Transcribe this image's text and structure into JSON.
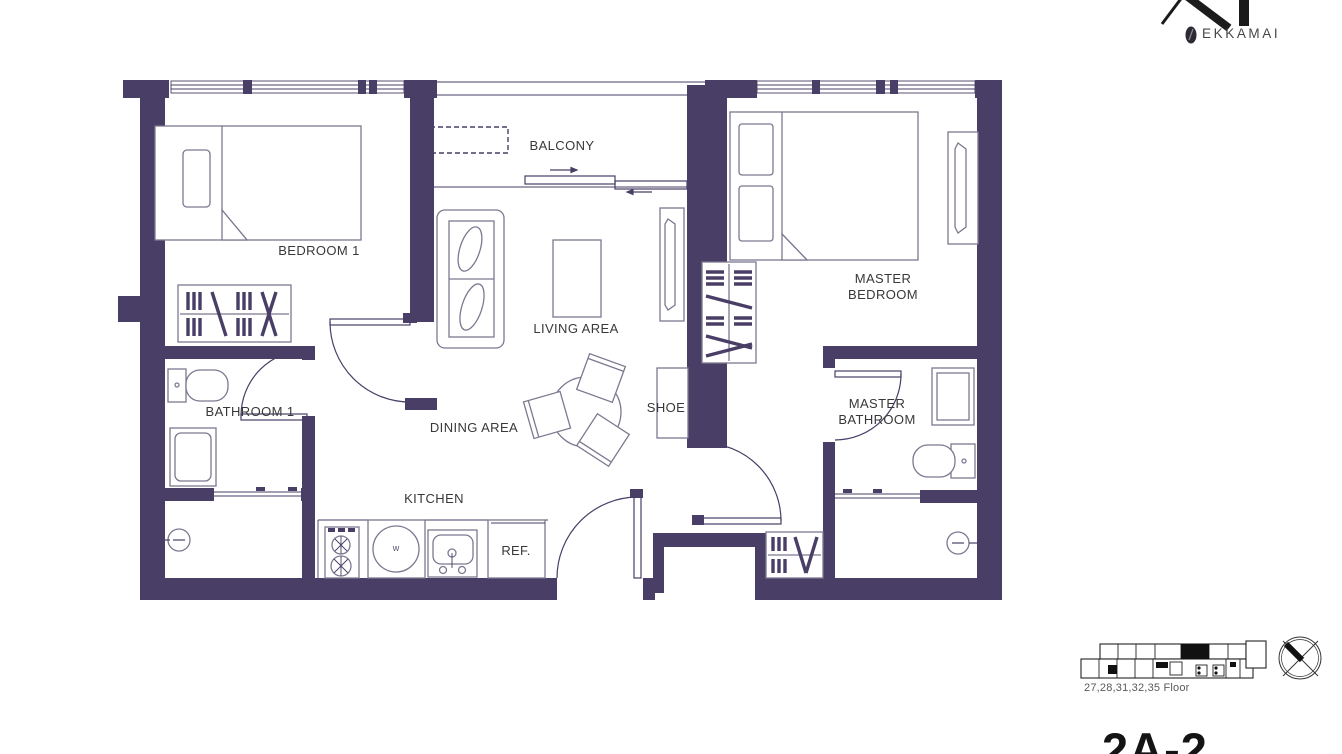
{
  "logo": {
    "monogram": "XT",
    "brand": "EKKAMAI"
  },
  "plan": {
    "rooms": [
      {
        "id": "bedroom1",
        "label": "BEDROOM 1"
      },
      {
        "id": "balcony",
        "label": "BALCONY"
      },
      {
        "id": "master_bedroom",
        "label": "MASTER\nBEDROOM"
      },
      {
        "id": "living",
        "label": "LIVING AREA"
      },
      {
        "id": "dining",
        "label": "DINING AREA"
      },
      {
        "id": "shoe",
        "label": "SHOE"
      },
      {
        "id": "bathroom1",
        "label": "BATHROOM 1"
      },
      {
        "id": "master_bathroom",
        "label": "MASTER\nBATHROOM"
      },
      {
        "id": "kitchen",
        "label": "KITCHEN"
      }
    ],
    "fixtures": {
      "refrigerator": "REF.",
      "washer": "w"
    }
  },
  "keyplan": {
    "floors": "27,28,31,32,35 Floor"
  },
  "unit": {
    "name": "2A-2"
  },
  "colors": {
    "wall": "#483e66",
    "furniture_line": "#7d7890",
    "text": "#383838"
  }
}
